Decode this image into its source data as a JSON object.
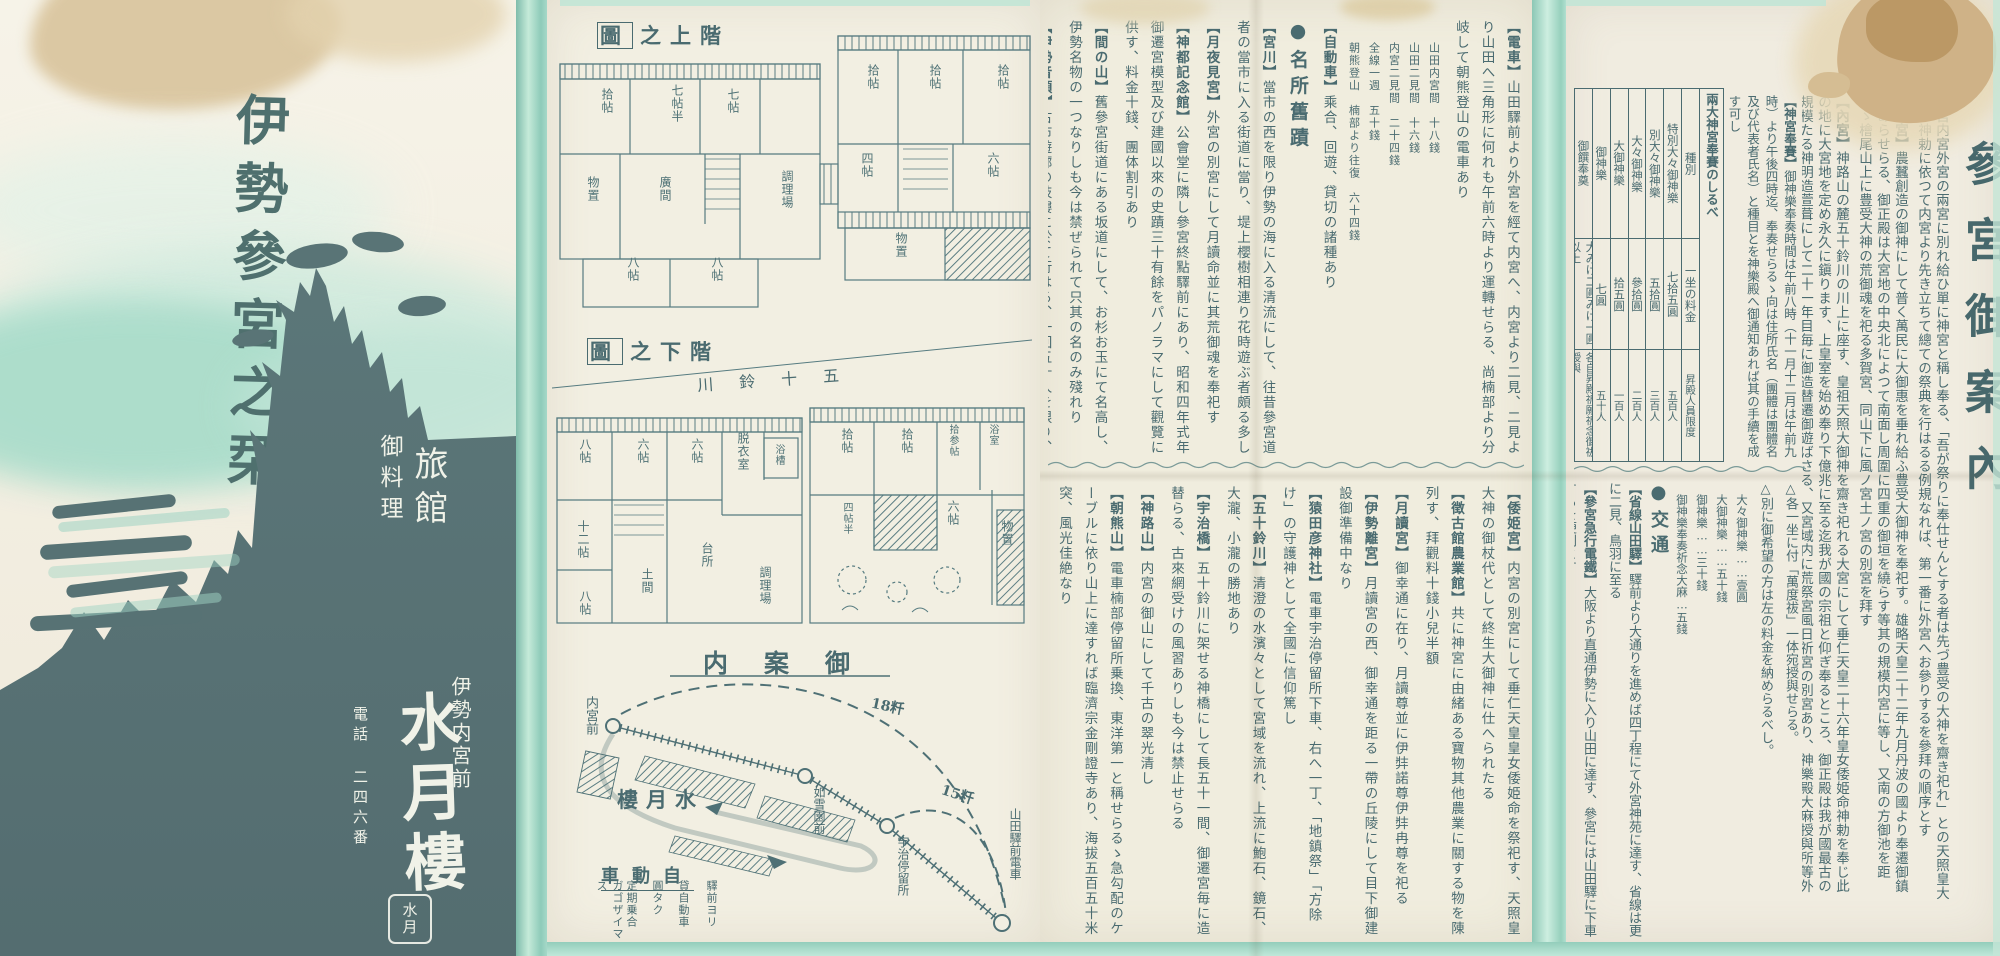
{
  "palette": {
    "ink": "#4a6b70",
    "mint": "#a9dbcc",
    "dark_panel": "#5b7477",
    "paper": "#f1eee0",
    "stain": "#d9c49c"
  },
  "cover": {
    "title": "伊勢參宮之栞",
    "shop_type": "旅館",
    "shop_type2": "御料理",
    "address": "伊勢内宮前",
    "name": "水月樓",
    "phone": "電話 二四六番",
    "seal_text": "水月"
  },
  "plans": {
    "upper_title_box": "圖",
    "upper_title_rest": "之上階",
    "lower_title_box": "圖",
    "lower_title_rest": "之下階",
    "river": "川鈴十五",
    "upper_rooms": [
      "拾帖",
      "七帖半",
      "七帖",
      "物置",
      "廣間",
      "調理場",
      "八帖",
      "八帖",
      "拾帖",
      "拾帖",
      "拾帖",
      "四帖",
      "六帖",
      "物置"
    ],
    "lower_rooms": [
      "八帖",
      "六帖",
      "六帖",
      "脱衣室",
      "浴槽",
      "十二帖",
      "土間",
      "台所",
      "調理場",
      "八帖",
      "拾帖",
      "拾帖",
      "四帖半",
      "六帖",
      "拾参帖",
      "浴室",
      "物置"
    ]
  },
  "map": {
    "title": "内案御",
    "stations": {
      "naiku": "内宮前",
      "josetsuen": "如雪園前",
      "uji": "宇治停留所",
      "yamada": "山田驛前電車"
    },
    "inn": "樓月水",
    "dist1": "18粁",
    "dist2": "15粁",
    "legend_title": "車動自",
    "legend_cols": [
      "驛前ヨリ",
      "貸自動車",
      "圓タク",
      "定期乗合",
      "ガゴザイマス"
    ]
  },
  "page3_top": {
    "sections": [
      {
        "heading": "【電車】",
        "body": "山田驛前より外宮を經て内宮へ、内宮より二見、二見より山田へ三角形に何れも午前六時より運轉せらる、尚楠部より分岐して朝熊登山の電車あり"
      },
      {
        "fares": [
          "山田内宮間　十八錢",
          "山田二見間　十六錢",
          "内宮二見間　二十四錢",
          "全線一週　五十錢",
          "朝熊登山　楠部より往復　六十四錢"
        ]
      },
      {
        "heading": "【自動車】",
        "body": "乘合、回遊、貸切の諸種あり"
      },
      {
        "divider": "●名所舊蹟"
      },
      {
        "heading": "【宮川】",
        "body": "當市の西を限り伊勢の海に入る清流にして、往昔參宮道者の當市に入る街道に當り、堤上櫻樹相連り花時遊ぶ者頗る多し"
      },
      {
        "heading": "【月夜見宮】",
        "body": "外宮の別宮にして月讀命並に其荒御魂を奉祀す"
      },
      {
        "heading": "【神都記念館】",
        "body": "公會堂に隣し參宮終點驛前にあり、昭和四年式年御遷宮模型及び建國以來の史蹟三十有餘をパノラマにして觀覽に供す、料金十錢、團体割引あり"
      },
      {
        "heading": "【間の山】",
        "body": "舊參宮街道にある坂道にして、お杉お玉にて名高し、伊勢名物の一つなりしも今は禁ぜられて只其の名のみ殘れり"
      },
      {
        "heading": "【伊勢音頭】",
        "body": "古市遊廓の妓樓に於て行はる、一回五十人を限り、料金五圓三十餘錢"
      },
      {
        "heading": "【倉田山公園】",
        "body": "電鐵倉田山停留所下車、倭姫宮、徴古館、農業館、神宮文庫、神宮皇學館等此の内にあり"
      }
    ]
  },
  "page3_bottom": {
    "sections": [
      {
        "heading": "【倭姫宮】",
        "body": "内宮の別宮にして垂仁天皇皇女倭姫命を祭祀す、天照皇大神の御杖代として終生大御神に仕へられたる"
      },
      {
        "heading": "【徴古館農業館】",
        "body": "共に神宮に由緒ある寶物其他農業に關する物を陳列す、拜觀料十錢小兒半額"
      },
      {
        "heading": "【月讀宮】",
        "body": "御幸通に在り、月讀尊並に伊弉諾尊伊弉冉尊を祀る"
      },
      {
        "heading": "【伊勢離宮】",
        "body": "月讀宮の西、御幸通を距る一帶の丘陵にして目下御建設御準備中なり"
      },
      {
        "heading": "【猿田彦神社】",
        "body": "電車宇治停留所下車、右へ一丁、「地鎮祭」「方除け」の守護神として全國に信仰篤し"
      },
      {
        "heading": "【五十鈴川】",
        "body": "清澄の水濱々として宮域を流れ、上流に鮑石、鏡石、大瀧、小瀧の勝地あり"
      },
      {
        "heading": "【宇治橋】",
        "body": "五十鈴川に架せる神橋にして長五十一間、御遷宮毎に造替らる、古來網受けの風習ありしも今は禁止せらる"
      },
      {
        "heading": "【神路山】",
        "body": "内宮の御山にして千古の翠光清し"
      },
      {
        "heading": "【朝熊山】",
        "body": "電車楠部停留所乗換、東洋第一と稱せらるゝ急勾配のケーブルに依り山上に達すれば臨濟宗金剛證寺あり、海拔五百五十米突、風光佳絶なり"
      },
      {
        "heading": "【二見浦】",
        "body": "内宮停留所、又宇治停留所より電車にて行くこと三十分、白砂青松の地、海中に夫婦岩あり"
      },
      {
        "heading": "【鳥羽港】",
        "body": "港内水深く島嶼点々、日和山、樋の山よりの眺望佳なり、志摩電鐵により賢島に至る"
      }
    ]
  },
  "page5": {
    "headline": "參宮御案內",
    "sections_main": [
      {
        "heading": "神宮",
        "body": "内宮外宮の兩宮に別れ給ひ單に神宮と稱し奉る、「吾が祭りに奉仕せんとする者は先づ豊受の大神を齋き祀れ」との天照皇大神の神勅に依つて内宮より先き立ちて總ての祭典を行はるる例規なれば、第一番に外宮へお參りするを參拜の順序とす"
      },
      {
        "heading": "【外宮】",
        "body": "農蠶創造の御神にして普く萬民に大御惠を垂れ給ふ豊受大御神を奉祀す。雄略天皇二十二年九月丹波の國より奉遷御鎮座あらせらる、御正殿は大宮地の中央北によつて南面し周圍に四重の御垣を繞らす等其の規模内宮に等し、又南の方御池を距てゝ檜尾山上に豊受大神の荒御魂を祀る多賀宮、同山下に風ノ宮土ノ宮の別宮を拜す"
      },
      {
        "heading": "【內宮】",
        "body": "神路山の麓五十鈴川の川上に座す、皇祖天照大御神を齋き祀れる大宮にして垂仁天皇二十六年皇女倭姫命神勅を奉じ此の地に大宮地を定め永久に鎭ります、上皇室を始め奉り下億兆に至る迄我が國の宗祖と仰ぎ奉るところ、御正殿は我が國最古の規模たる神明造萱葺にして二十一年目毎に御造替遷御遊ばさる、又宮域内に荒祭宮風日祈宮の別宮あり、神樂殿大麻授與所等外宮に同じ"
      }
    ],
    "sections_hosai": [
      {
        "heading": "【神宮奉賽】",
        "body": "御神樂奉奏時間は午前八時（十一月十二月は午前九時）より午後四時迄、奉奏せらるゝ向は住所氏名（團體は團體名及び代表者氏名）と種目とを神樂殿へ御通知あれば其の手續を成す可し"
      }
    ],
    "table": {
      "title": "兩大神宮奉賽のしるべ",
      "headers": [
        "種別",
        "一坐の料金",
        "昇殿人員限度"
      ],
      "rows": [
        [
          "特別大々御神樂",
          "七拾五圓",
          "五百人"
        ],
        [
          "別大々御神樂",
          "五拾圓",
          "三百人"
        ],
        [
          "大々御神樂",
          "參拾圓",
          "二百人"
        ],
        [
          "大御神樂",
          "拾五圓",
          "一百人"
        ],
        [
          "御神樂",
          "七圓",
          "五十人"
        ],
        [
          "御饌奉奠",
          "大みけ二圓みけ一圓以上",
          "各自昇殿祈願祈念御祓授與"
        ]
      ]
    },
    "bottom_flow": {
      "sections": [
        {
          "body": "△各一坐に付「萬度祓」一体宛授與せらる。"
        },
        {
          "body": "△別に御希望の方は左の料金を納めらるべし。"
        },
        {
          "fares": [
            "大々御神樂……壹圓",
            "大御神樂……五十錢",
            "御神樂……三十錢",
            "御神樂奉奏祈念大麻…五錢"
          ]
        },
        {
          "divider": "●交通"
        },
        {
          "heading": "【省線山田驛】",
          "body": "驛前より大通りを進めば四丁程にて外宮神苑に達す、省線は更に二見、鳥羽に至る"
        },
        {
          "heading": "【參宮急行電鐵】",
          "body": "大阪より直通伊勢に入り山田に達す、參宮には山田驛に下車するを便利とす"
        },
        {
          "heading": "【伊勢電鐵】",
          "body": "線路は外宮神苑に沿ふて山田に達し、終點大神宮前驛は神苑に接す"
        }
      ]
    }
  }
}
